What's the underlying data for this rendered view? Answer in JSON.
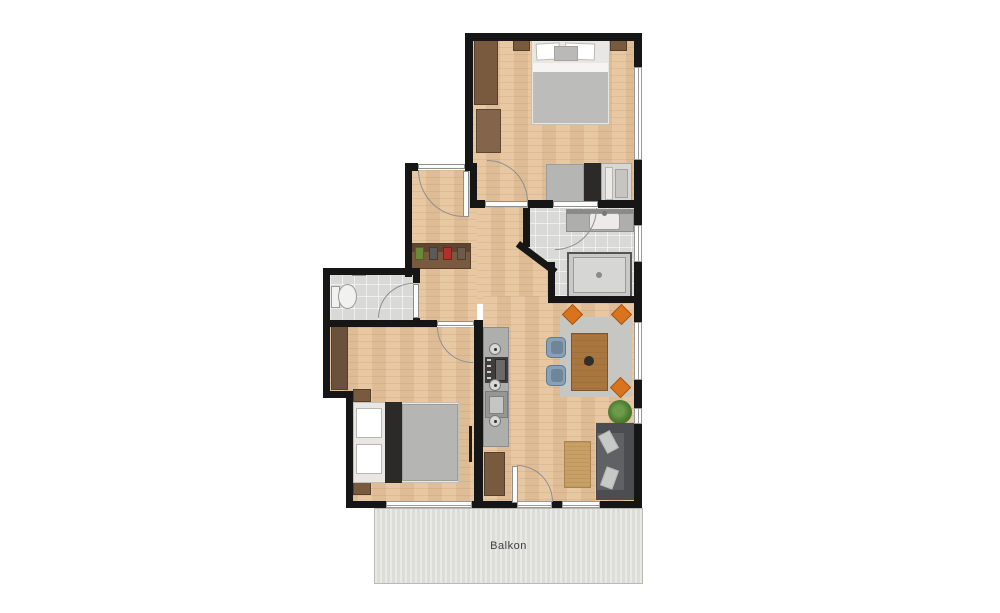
{
  "labels": {
    "balcony": "Balkon"
  },
  "palette": {
    "wall": "#161616",
    "wood_floor": "#e6c49c",
    "tile_floor": "#d9d9d7",
    "balcony_deck": "#e2e2de",
    "furniture_brown": "#7a5a3e",
    "mattress_gray": "#b5b5b3",
    "sofa_gray": "#5f6165",
    "chair_orange": "#d9731e",
    "chair_blue": "#8aa0b5",
    "rug_tan": "#c8a065",
    "plant_green": "#4e7d33"
  },
  "rooms": [
    {
      "name": "bedroom-top",
      "furniture": [
        "double-bed",
        "nightstand-left",
        "nightstand-right",
        "wardrobe",
        "dresser",
        "daybed",
        "side-cabinet",
        "armchair"
      ]
    },
    {
      "name": "hallway",
      "furniture": [
        "entrance-door",
        "shoe-sideboard"
      ]
    },
    {
      "name": "wc",
      "furniture": [
        "toilet",
        "hand-basin"
      ]
    },
    {
      "name": "bathroom",
      "furniture": [
        "vanity-sink",
        "shower"
      ]
    },
    {
      "name": "bedroom-lower",
      "furniture": [
        "double-bed",
        "wardrobe",
        "nightstand-top",
        "nightstand-bottom"
      ]
    },
    {
      "name": "living-dining",
      "furniture": [
        "kitchenette-counter",
        "oven",
        "sink",
        "dining-table",
        "orange-chairs",
        "blue-chairs",
        "sofa",
        "sofa-rug",
        "sideboard",
        "plant"
      ]
    },
    {
      "name": "balcony",
      "label": "Balkon"
    }
  ]
}
